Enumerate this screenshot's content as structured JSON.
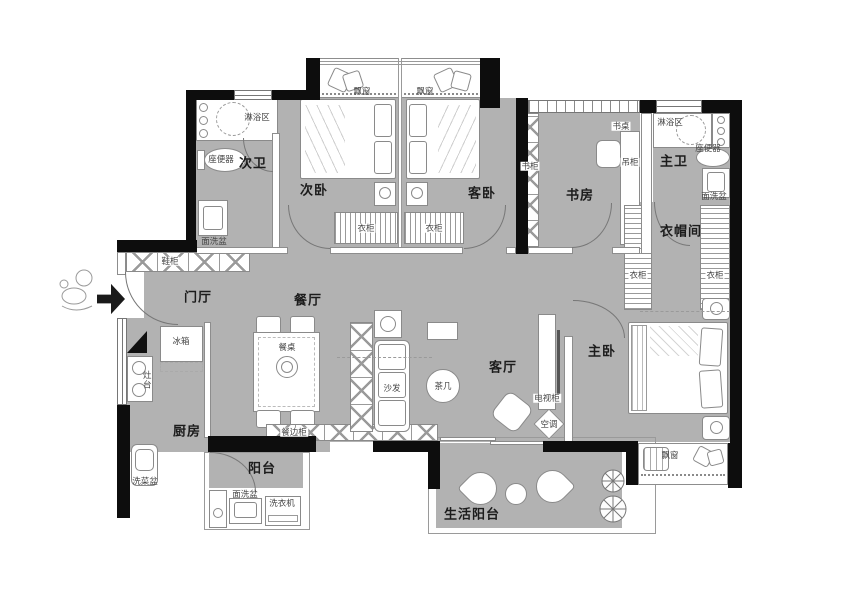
{
  "title": "apartment-floor-plan",
  "colors": {
    "floor": "#b2b2b2",
    "wall": "#0d0d0d",
    "outline": "#8a8a8a",
    "background": "#ffffff"
  },
  "rooms": {
    "men_ting": "门厅",
    "can_ting": "餐厅",
    "ke_ting": "客厅",
    "chu_fang": "厨房",
    "ci_wei": "次卫",
    "ci_wo": "次卧",
    "ke_wo": "客卧",
    "shu_fang": "书房",
    "zhu_wei": "主卫",
    "yi_mao_jian": "衣帽间",
    "zhu_wo": "主卧",
    "yang_tai": "阳台",
    "shenghuo_yangtai": "生活阳台"
  },
  "items": {
    "lin_yu_qu": "淋浴区",
    "zuo_bian_qi": "座便器",
    "mian_xi_pen": "面洗盆",
    "piao_chuang": "飘窗",
    "yi_gui": "衣柜",
    "xie_gui": "鞋柜",
    "bing_xiang": "冰箱",
    "zao_tai": "灶台",
    "xi_cai_pen": "洗菜盆",
    "can_zhuo": "餐桌",
    "can_bian_gui": "餐边柜",
    "sha_fa": "沙发",
    "cha_ji": "茶几",
    "dian_shi_gui": "电视柜",
    "kong_tiao": "空调",
    "xi_yi_ji": "洗衣机",
    "shu_gui": "书柜",
    "shu_zhuo": "书桌",
    "diao_gui": "吊柜"
  }
}
